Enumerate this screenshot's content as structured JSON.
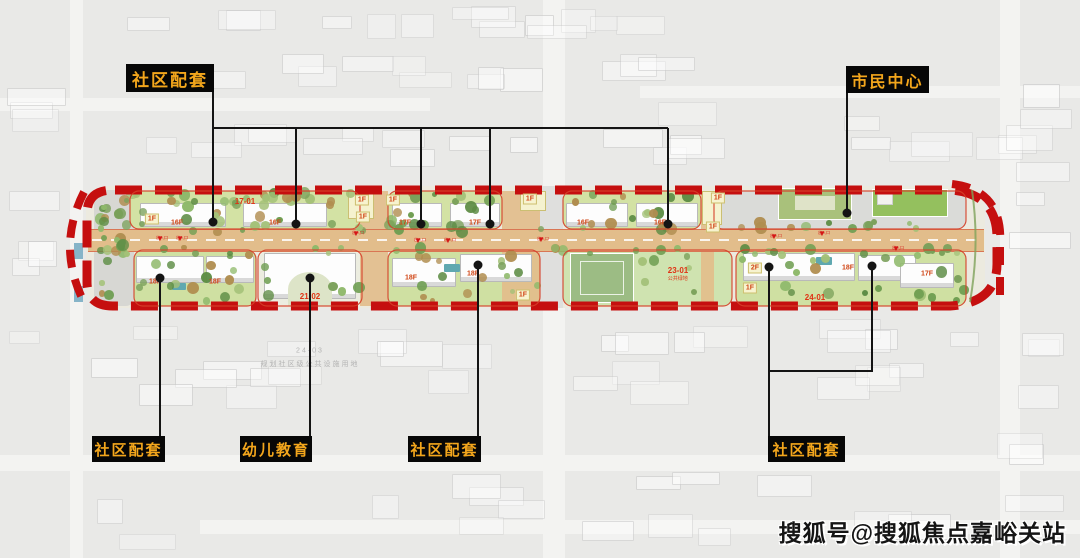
{
  "callouts": [
    {
      "id": "community-top",
      "text": "社区配套"
    },
    {
      "id": "civic-center",
      "text": "市民中心"
    },
    {
      "id": "community-bottom-left",
      "text": "社区配套"
    },
    {
      "id": "kindergarten",
      "text": "幼儿教育"
    },
    {
      "id": "community-bottom-middle",
      "text": "社区配套"
    },
    {
      "id": "community-bottom-right",
      "text": "社区配套"
    }
  ],
  "floor_labels": [
    {
      "text": "1F",
      "x": 152,
      "y": 219,
      "tag": true
    },
    {
      "text": "16F",
      "x": 177,
      "y": 223,
      "tag": false
    },
    {
      "text": "16F",
      "x": 275,
      "y": 223,
      "tag": false
    },
    {
      "text": "1F",
      "x": 362,
      "y": 200,
      "tag": true
    },
    {
      "text": "1F",
      "x": 363,
      "y": 217,
      "tag": true
    },
    {
      "text": "1F",
      "x": 393,
      "y": 200,
      "tag": true
    },
    {
      "text": "17F",
      "x": 405,
      "y": 223,
      "tag": false
    },
    {
      "text": "17F",
      "x": 475,
      "y": 223,
      "tag": false
    },
    {
      "text": "1F",
      "x": 530,
      "y": 199,
      "tag": true
    },
    {
      "text": "16F",
      "x": 583,
      "y": 223,
      "tag": false
    },
    {
      "text": "16F",
      "x": 660,
      "y": 223,
      "tag": false
    },
    {
      "text": "1F",
      "x": 718,
      "y": 198,
      "tag": true
    },
    {
      "text": "1F",
      "x": 713,
      "y": 227,
      "tag": true
    },
    {
      "text": "18F",
      "x": 155,
      "y": 282,
      "tag": false
    },
    {
      "text": "18F",
      "x": 215,
      "y": 282,
      "tag": false
    },
    {
      "text": "18F",
      "x": 411,
      "y": 278,
      "tag": false
    },
    {
      "text": "18F",
      "x": 473,
      "y": 274,
      "tag": false
    },
    {
      "text": "1F",
      "x": 523,
      "y": 295,
      "tag": true
    },
    {
      "text": "2F",
      "x": 755,
      "y": 268,
      "tag": true
    },
    {
      "text": "1F",
      "x": 750,
      "y": 288,
      "tag": true
    },
    {
      "text": "18F",
      "x": 848,
      "y": 268,
      "tag": false
    },
    {
      "text": "17F",
      "x": 927,
      "y": 274,
      "tag": false
    }
  ],
  "parcel_labels": [
    {
      "text": "17-01",
      "x": 245,
      "y": 202,
      "sub": ""
    },
    {
      "text": "21-02",
      "x": 310,
      "y": 297,
      "sub": ""
    },
    {
      "text": "23-01",
      "x": 678,
      "y": 271,
      "sub": "公共绿地"
    },
    {
      "text": "24-01",
      "x": 815,
      "y": 298,
      "sub": ""
    }
  ],
  "background_labels": [
    {
      "text": "24-03",
      "x": 310,
      "y": 351
    },
    {
      "text": "规划社区级公共设施用地",
      "x": 310,
      "y": 364
    }
  ],
  "entrance_markers": [
    {
      "x": 176,
      "y": 236,
      "label": "出入口"
    },
    {
      "x": 196,
      "y": 236,
      "label": "出入口"
    },
    {
      "x": 372,
      "y": 231,
      "label": "出入口"
    },
    {
      "x": 434,
      "y": 238,
      "label": "出入口"
    },
    {
      "x": 464,
      "y": 238,
      "label": "出入口"
    },
    {
      "x": 557,
      "y": 237,
      "label": "出入口"
    },
    {
      "x": 790,
      "y": 234,
      "label": "出入口"
    },
    {
      "x": 838,
      "y": 231,
      "label": "出入口"
    },
    {
      "x": 912,
      "y": 246,
      "label": "出入口"
    }
  ],
  "watermark": {
    "text": "搜狐号@搜狐焦点嘉峪关站"
  },
  "colors": {
    "callout_bg": "#070707",
    "callout_text": "#f3a61c",
    "boundary_red": "#c50f0f",
    "parcel_outline_red": "#d5402a",
    "leader_black": "#141414",
    "road_tan": "#e2bd8b",
    "floor_label_red": "#d04515",
    "parcel_code_red": "#e03214"
  }
}
